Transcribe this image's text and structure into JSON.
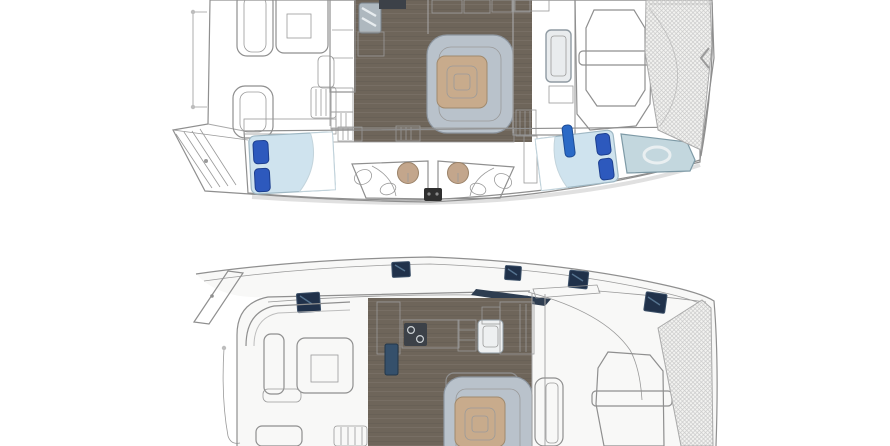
{
  "page": {
    "title": "Catamaran layout drawing — two deck plans, white background, no text labels",
    "background": "#ffffff"
  },
  "palette": {
    "background": "#ffffff",
    "hull_fill": "#f8f8f7",
    "deck_white": "#f4f4f2",
    "outline_gray": "#8f8f8f",
    "shadow_gray": "#d8d8d8",
    "wood_floor": "#6e655a",
    "wood_floor_dark": "#5d564d",
    "tan_furniture": "#cbb299",
    "tan_dark": "#b7987c",
    "cream": "#efeae1",
    "sofa_silver": "#b9c2cb",
    "bed_mattress_blue": "#cfe3ee",
    "pillow_navy": "#2d59bd",
    "hatch_navy": "#20314a",
    "steel_sink": "#aeb8bf",
    "basin_tan": "#c3a68c",
    "mesh_gray": "#c9c9c9",
    "forepeak_blue": "#c3d7de"
  },
  "plans": {
    "top": {
      "label": "Upper plan: saloon deck and starboard hull cabins, bow to the right, cropped at top edge",
      "features": {
        "rail": "stern safety rail",
        "swim_steps": "transom swim steps",
        "cockpit": "aft cockpit with L-bench and square table",
        "galley": "galley with stainless sink, stove and tall lockers",
        "dinette": "saloon dinette with silver U-sofa and tan table",
        "aft_berth": "aft double berth, blue mattress with two navy pillows",
        "heads": "twin heads with round tan basins and toilets",
        "fwd_berth": "forward double berth, blue mattress with two navy pillows",
        "forepeak": "forepeak locker berth",
        "sunpad": "coachroof sun lounger",
        "trampoline": "bow trampoline mesh"
      }
    },
    "bottom": {
      "label": "Lower plan: deck and saloon of second layout, bow to the right, cropped at bottom edge",
      "features": {
        "davit": "stern davit arm and rail",
        "cockpit": "aft cockpit with bench seats and square table",
        "hatches": "five navy deck hatches and cabin window",
        "coachroof_window": "angled dark coachroof window",
        "galley": "galley with stove, shelves, sink and tan lockers",
        "dinette": "saloon dinette with silver sofa and tan table",
        "side_deck": "starboard side deck",
        "sunpad": "foredeck sun lounger",
        "trampoline": "bow trampoline mesh"
      }
    }
  }
}
